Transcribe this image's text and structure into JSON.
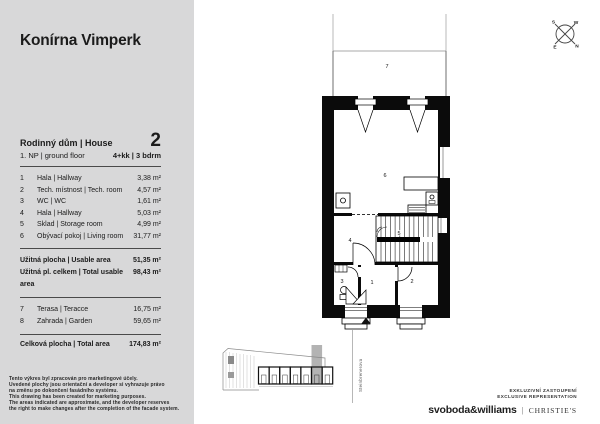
{
  "page": {
    "title": "Konírna Vimperk"
  },
  "colors": {
    "panel_bg": "#d8d8d9",
    "wall": "#0b0b0b",
    "unit_highlight": "#b3b3b3"
  },
  "panel": {
    "head": {
      "name": "Rodinný dům | House",
      "number": "2",
      "floor": "1. NP | ground floor",
      "layout": "4+kk | 3 bdrm"
    },
    "rooms": [
      {
        "no": "1",
        "name": "Hala | Hallway",
        "area": "3,38 m²"
      },
      {
        "no": "2",
        "name": "Tech. místnost | Tech. room",
        "area": "4,57 m²"
      },
      {
        "no": "3",
        "name": "WC | WC",
        "area": "1,61 m²"
      },
      {
        "no": "4",
        "name": "Hala | Hallway",
        "area": "5,03 m²"
      },
      {
        "no": "5",
        "name": "Sklad | Storage room",
        "area": "4,99 m²"
      },
      {
        "no": "6",
        "name": "Obývací pokoj | Living room",
        "area": "31,77 m²"
      }
    ],
    "summary": [
      {
        "name": "Užitná plocha | Usable area",
        "area": "51,35 m²"
      },
      {
        "name": "Užitná pl. celkem | Total usable area",
        "area": "98,43 m²"
      }
    ],
    "outdoor": [
      {
        "no": "7",
        "name": "Terasa | Teracce",
        "area": "16,75 m²"
      },
      {
        "no": "8",
        "name": "Zahrada | Garden",
        "area": "59,65 m²"
      }
    ],
    "total": {
      "name": "Celková plocha | Total area",
      "area": "174,83 m²"
    },
    "disclaimer": [
      "Tento výkres byl zpracován pro marketingové účely.",
      "Uvedené plochy jsou orientační a developer si vyhrazuje právo",
      "na změnu po dokončení fasádního systému.",
      "This drawing has been created for marketing purposes.",
      "The areas indicated are approximate, and the developer reserves",
      "the right to make changes after the completion of the facade system."
    ]
  },
  "plan": {
    "labels": {
      "room1": "1",
      "room2": "2",
      "room3": "3",
      "room4": "4",
      "room5": "5",
      "room6": "6",
      "terrace": "7"
    },
    "street": "Steinbrenerova",
    "compass": {
      "s": "S",
      "w": "W",
      "e": "E",
      "n": "N"
    }
  },
  "footer": {
    "exclusive_cz": "EXKLUZIVNÍ ZASTOUPENÍ",
    "exclusive_en": "EXCLUSIVE REPRESENTATION",
    "brand_left": "svoboda&williams",
    "brand_right": "CHRISTIE'S"
  }
}
